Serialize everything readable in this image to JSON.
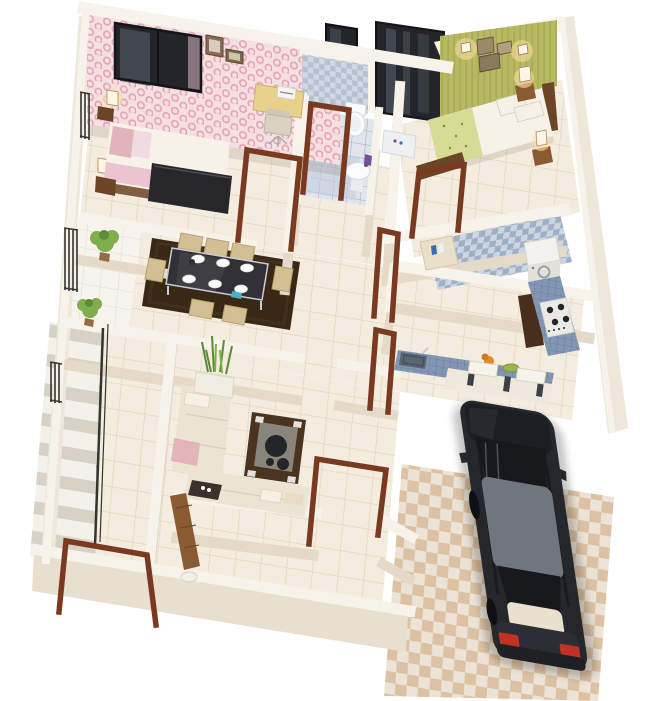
{
  "scene": {
    "type": "3d-isometric-floor-plan-render",
    "canvas": {
      "width": 650,
      "height": 701
    },
    "background": "#ffffff",
    "colors": {
      "wallTop": "#f8f3ea",
      "wallFace": "#e5dac8",
      "wallFaceLight": "#efe7d9",
      "wallFaceDark": "#e8dfcf",
      "floor": "#f3ecdf",
      "floorLine": "#e0d3bd",
      "ledge": "#f7f4ee",
      "ledgeLine": "#e2ddd2",
      "pinkBase": "#f6dfe1",
      "pinkDot": "#e2a4b6",
      "greenWall": "#b8b963",
      "greenStripe": "#a8a953",
      "bathTileA": "#cfd8e4",
      "bathTileB": "#b6c2d2",
      "bathFloor": "#dfe4ed",
      "bathFloorLine": "#9fadc2",
      "shower": "#c5cfdb",
      "counter": "#8297b3",
      "counterLine": "#66799a",
      "utilA": "#9fb0c6",
      "utilB": "#ccd6e2",
      "driveA": "#dcc2a2",
      "driveB": "#ece3d6",
      "wood": "#7a3a20",
      "woodDark": "#5e2c16",
      "furnWood": "#6b4526",
      "benchWood": "#8a5a32",
      "rug": "#3a2817",
      "sofa": "#ece4d2",
      "cushion": "#f6f1e6",
      "pinkThrow": "#dfadb5",
      "chair": "#d3bf92",
      "chairEdge": "#b9a272",
      "tableTop": "#303036",
      "steel": "#c9ccd2",
      "plate": "#fafaf8",
      "teal": "#4ab0c8",
      "plant": "#7fae4a",
      "plantDark": "#5c8a36",
      "planter": "#f2ede3",
      "stairA": "#f4f1ea",
      "stairB": "#d8d2c6",
      "rail": "#35342f",
      "darkPanel": "#23252a",
      "panelStreak": "#5d636e",
      "cream": "#f6f2e8",
      "glow": "#ffdf9e",
      "lampShade": "#fdf6e3",
      "carBody": "#24272c",
      "carHood": "#1b1e22",
      "carRoof": "#70767e",
      "carGlass": "#16181c",
      "carDeck": "#e9e1cd",
      "tailRed": "#c23122",
      "orange": "#e08a28",
      "dish": "#9ab44a",
      "applianceWhite": "#f4f2ee",
      "applianceFront": "#e4e1db",
      "toiletWhite": "#fbfcfd",
      "fixtureEdge": "#d5d8db",
      "purple": "#7a4fa0",
      "detergentBlue": "#3a6ab0"
    },
    "rooms": [
      {
        "id": "bedroom-1",
        "label": "bedroom with pink polka-dot wallpaper",
        "features": [
          "double-bed",
          "desk",
          "chair",
          "window",
          "wall-frames",
          "night-lamps"
        ]
      },
      {
        "id": "bathroom",
        "label": "bathroom with blue checker tiles",
        "features": [
          "toilet",
          "wash-basin",
          "shower-area",
          "small-window"
        ]
      },
      {
        "id": "wardrobe",
        "label": "mirrored wardrobe panel",
        "features": [
          "dressing-table"
        ]
      },
      {
        "id": "bedroom-2",
        "label": "bedroom with green wall",
        "features": [
          "double-bed",
          "green-floral-blanket",
          "wall-sconces",
          "picture-frames",
          "bench",
          "night-lamps"
        ]
      },
      {
        "id": "utility",
        "label": "utility / wash area",
        "features": [
          "washing-machine",
          "counter"
        ]
      },
      {
        "id": "kitchen",
        "label": "kitchen with blue mosaic counters",
        "features": [
          "l-shaped-counter",
          "gas-stove",
          "sink",
          "tall-cabinet",
          "fruit"
        ]
      },
      {
        "id": "dining",
        "label": "dining area",
        "features": [
          "glass-table",
          "six-chairs",
          "six-plates",
          "brown-shag-rug"
        ]
      },
      {
        "id": "hallway",
        "label": "central hallway",
        "features": [
          "tiled-floor",
          "door-frames"
        ]
      },
      {
        "id": "living",
        "label": "living area",
        "features": [
          "l-shaped-sofa",
          "coffee-table",
          "tv-unit",
          "planter"
        ]
      },
      {
        "id": "staircase",
        "label": "staircase with dark handrail",
        "features": [
          "steps",
          "parapet",
          "ledge-plants"
        ]
      },
      {
        "id": "foyer",
        "label": "foyer / sit-out",
        "features": [
          "entry-door-frame",
          "wooden-bench",
          "stool"
        ]
      },
      {
        "id": "driveway",
        "label": "driveway garage with checker tiles",
        "features": [
          "parked-sedan"
        ]
      }
    ],
    "vehicle": {
      "type": "sedan",
      "color": "dark-charcoal",
      "roof": "grey",
      "taillights": "red",
      "location": "driveway"
    },
    "counts": {
      "bedrooms": 2,
      "bathrooms": 1,
      "dining_chairs": 6,
      "dining_plates": 6,
      "ledge_plants": 2
    }
  }
}
